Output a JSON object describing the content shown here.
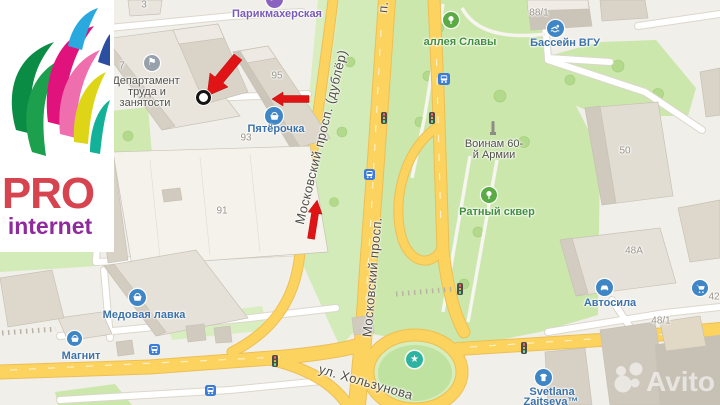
{
  "logo": {
    "title": "PRO",
    "subtitle": "internet"
  },
  "watermark": {
    "brand": "Avito"
  },
  "map": {
    "street_labels": [
      {
        "name": "Московский просп. (дублёр)"
      },
      {
        "name": "Московский просп."
      },
      {
        "name": "п."
      },
      {
        "name": "ул. Хользунова"
      }
    ],
    "pois": [
      {
        "name": "Парикмахерская",
        "icon": "scissors"
      },
      {
        "lines": [
          "Департамент",
          "труда и",
          "занятости"
        ],
        "icon": "flag"
      },
      {
        "name": "Пятёрочка",
        "icon": "basket"
      },
      {
        "name": "аллея Славы",
        "icon": "tree"
      },
      {
        "name": "Бассейн ВГУ",
        "icon": "swimmer"
      },
      {
        "lines": [
          "Воинам 60-",
          "й Армии"
        ],
        "icon": "monument"
      },
      {
        "name": "Ратный сквер",
        "icon": "tree"
      },
      {
        "name": "Автосила",
        "icon": "car"
      },
      {
        "name": "Медовая лавка",
        "icon": "basket"
      },
      {
        "name": "Магнит",
        "icon": "basket"
      },
      {
        "lines": [
          "Svetlana",
          "Zaitseva™"
        ],
        "icon": "t-shirt"
      },
      {
        "name": "",
        "icon": "cart"
      }
    ],
    "building_numbers": [
      "3",
      "7",
      "95",
      "93",
      "91",
      "88/1",
      "50",
      "48А",
      "42",
      "48/1"
    ],
    "colors": {
      "road_yellow": "#fdd35f",
      "park_green": "#cbe7ab",
      "poi_blue": "#3c72a8",
      "poi_green": "#3f8f3c",
      "poi_purple": "#7a5ab5",
      "arrow_red": "#e01414",
      "roundabout_star_teal": "#2db3a0"
    }
  }
}
